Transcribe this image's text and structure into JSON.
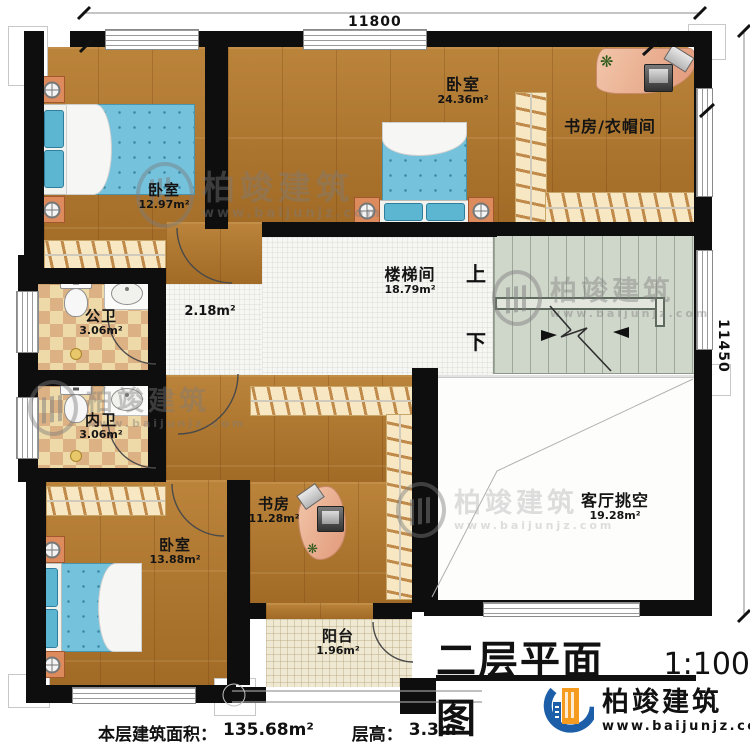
{
  "meta": {
    "title": "二层平面图",
    "scale": "1:100"
  },
  "dimensions": {
    "top": "11800",
    "right": "11450"
  },
  "rooms": {
    "bedroom_top_left": {
      "name": "卧室",
      "area": "12.97m²"
    },
    "bedroom_top_middle": {
      "name": "卧室",
      "area": "24.36m²"
    },
    "study_cloakroom": {
      "name": "书房/衣帽间"
    },
    "stairwell": {
      "name": "楼梯间",
      "area": "18.79m²"
    },
    "hallway": {
      "area": "2.18m²"
    },
    "public_bathroom": {
      "name": "公卫",
      "area": "3.06m²"
    },
    "private_bathroom": {
      "name": "内卫",
      "area": "3.06m²"
    },
    "bedroom_bottom_left": {
      "name": "卧室",
      "area": "13.88m²"
    },
    "study": {
      "name": "书房",
      "area": "11.28m²"
    },
    "living_room_void": {
      "name": "客厅挑空",
      "area": "19.28m²"
    },
    "balcony": {
      "name": "阳台",
      "area": "1.96m²"
    }
  },
  "stairs": {
    "up": "上",
    "down": "下"
  },
  "footer": {
    "area_label": "本层建筑面积：",
    "area_value": "135.68m²",
    "height_label": "层高：",
    "height_value": "3.3m"
  },
  "brand": {
    "name": "柏竣建筑",
    "url": "www.baijunjz.com"
  },
  "watermark": {
    "name": "柏竣建筑",
    "url": "www.baijunjz.com"
  },
  "colors": {
    "wall": "#0e0e0e",
    "wood": "#b0762c",
    "mattress": "#74c2dc",
    "brand_blue": "#1c5fa8",
    "brand_orange": "#f59b20"
  }
}
